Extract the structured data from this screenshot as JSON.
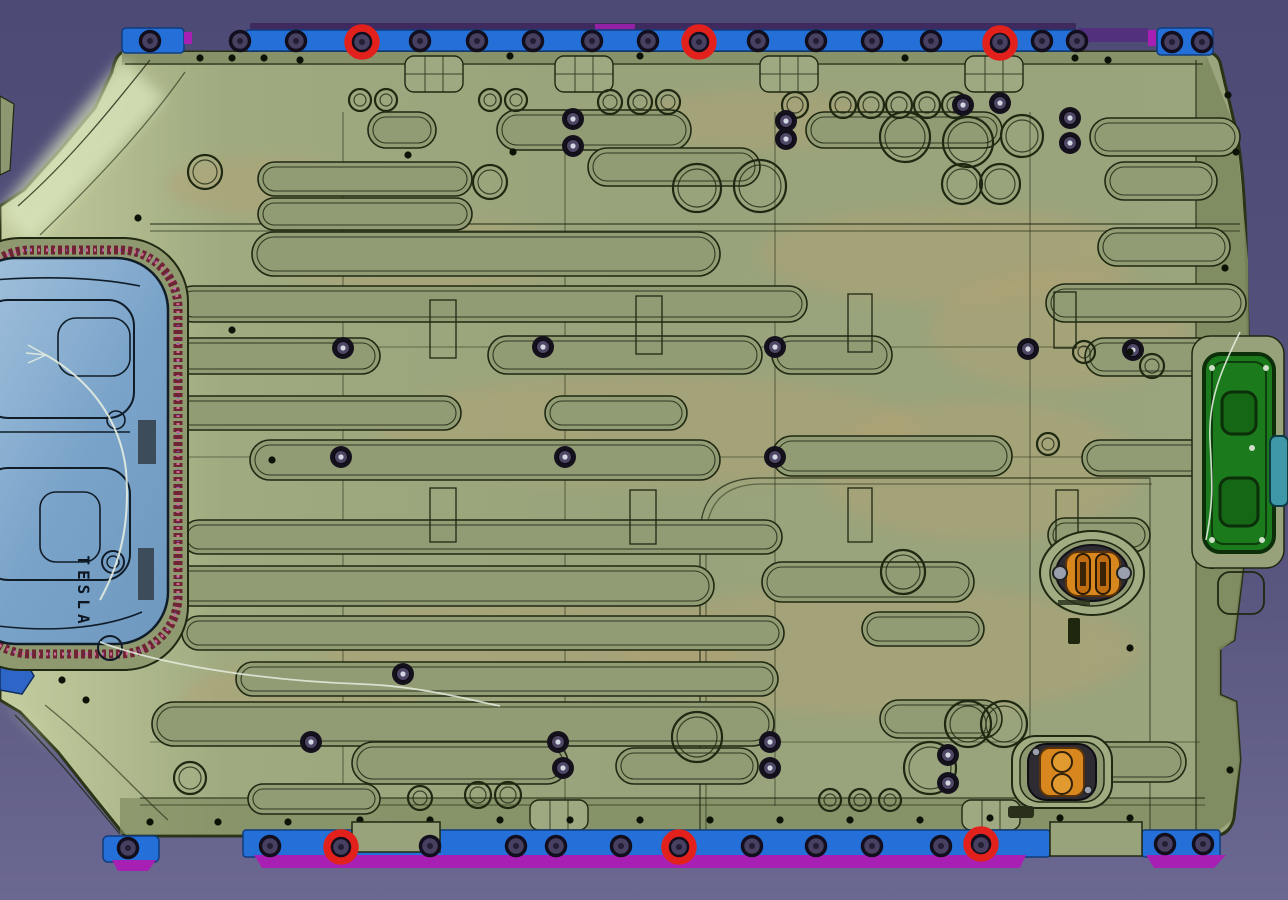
{
  "scene": {
    "type": "cad-viewport",
    "part_label": "TESLA",
    "palette": {
      "bg_top": "#4d4a76",
      "bg_mid": "#56537d",
      "bg_bottom": "#6b6892",
      "body": "#99a37b",
      "body_light": "#cdd7ac",
      "body_dark": "#7d895e",
      "body_band": "#8a9569",
      "line": "#1f2811",
      "channel": "#929c74",
      "rail_blue": "#2470d8",
      "rail_blue_dark": "#113c7e",
      "magenta": "#a81fb4",
      "purple_strip": "#3f2a60",
      "bolt_fill": "#474060",
      "bolt_ring": "#120e1d",
      "tan": "#b3a274",
      "panel_blue": "#7ea7cb",
      "panel_blue_light": "#a8c6e0",
      "panel_line": "#101d29",
      "gasket_dark": "#6f2436",
      "gasket_pink": "#cf6e94",
      "cover_green": "#1b7a1c",
      "cover_green_dark": "#0c2f0a",
      "orange": "#d8871f",
      "orange_dark": "#5a3408",
      "housing": "#2e2b33",
      "teal": "#3f98a8",
      "highlight_red": "#e2211c",
      "wire": "#e4ecdf",
      "screw_dark": "#14111c",
      "screw_mid": "#4e4766",
      "screw_glint": "#d3d7e2",
      "dot": "#0d1207"
    },
    "highlight_circles": [
      [
        362,
        42
      ],
      [
        699,
        42
      ],
      [
        1000,
        43
      ],
      [
        341,
        847
      ],
      [
        679,
        847
      ],
      [
        981,
        844
      ]
    ],
    "top_rail_bolts": [
      [
        150,
        41
      ],
      [
        240,
        41
      ],
      [
        296,
        41
      ],
      [
        362,
        42
      ],
      [
        420,
        41
      ],
      [
        477,
        41
      ],
      [
        533,
        41
      ],
      [
        592,
        41
      ],
      [
        648,
        41
      ],
      [
        699,
        42
      ],
      [
        758,
        41
      ],
      [
        816,
        41
      ],
      [
        872,
        41
      ],
      [
        931,
        41
      ],
      [
        1000,
        42
      ],
      [
        1042,
        41
      ],
      [
        1077,
        41
      ],
      [
        1172,
        42
      ],
      [
        1202,
        42
      ]
    ],
    "bottom_rail_bolts": [
      [
        128,
        848
      ],
      [
        270,
        846
      ],
      [
        341,
        847
      ],
      [
        430,
        846
      ],
      [
        516,
        846
      ],
      [
        556,
        846
      ],
      [
        621,
        846
      ],
      [
        679,
        847
      ],
      [
        752,
        846
      ],
      [
        816,
        846
      ],
      [
        872,
        846
      ],
      [
        941,
        846
      ],
      [
        981,
        845
      ],
      [
        1165,
        844
      ],
      [
        1203,
        844
      ]
    ],
    "coolant_channels": [
      [
        368,
        112,
        68,
        36
      ],
      [
        497,
        110,
        194,
        40
      ],
      [
        806,
        112,
        196,
        36
      ],
      [
        1090,
        118,
        150,
        38
      ],
      [
        258,
        162,
        214,
        34
      ],
      [
        588,
        148,
        172,
        38
      ],
      [
        1105,
        162,
        112,
        38
      ],
      [
        258,
        198,
        214,
        32
      ],
      [
        1098,
        228,
        132,
        38
      ],
      [
        252,
        232,
        468,
        44
      ],
      [
        175,
        286,
        632,
        36
      ],
      [
        1046,
        284,
        200,
        38
      ],
      [
        148,
        338,
        232,
        36
      ],
      [
        488,
        336,
        274,
        38
      ],
      [
        772,
        336,
        120,
        38
      ],
      [
        1085,
        338,
        158,
        38
      ],
      [
        165,
        396,
        296,
        34
      ],
      [
        545,
        396,
        142,
        34
      ],
      [
        250,
        440,
        470,
        40
      ],
      [
        772,
        436,
        240,
        40
      ],
      [
        1082,
        440,
        158,
        36
      ],
      [
        182,
        520,
        600,
        34
      ],
      [
        1048,
        518,
        102,
        34
      ],
      [
        152,
        566,
        562,
        40
      ],
      [
        762,
        562,
        212,
        40
      ],
      [
        182,
        616,
        602,
        34
      ],
      [
        862,
        612,
        122,
        34
      ],
      [
        236,
        662,
        542,
        34
      ],
      [
        152,
        702,
        622,
        44
      ],
      [
        880,
        700,
        122,
        38
      ],
      [
        352,
        742,
        216,
        42
      ],
      [
        616,
        748,
        142,
        36
      ],
      [
        1016,
        742,
        170,
        40
      ],
      [
        248,
        784,
        132,
        30
      ]
    ],
    "bosses": [
      [
        360,
        100,
        11
      ],
      [
        386,
        100,
        11
      ],
      [
        490,
        100,
        11
      ],
      [
        516,
        100,
        11
      ],
      [
        610,
        102,
        12
      ],
      [
        640,
        102,
        12
      ],
      [
        668,
        102,
        12
      ],
      [
        795,
        105,
        13
      ],
      [
        843,
        105,
        13
      ],
      [
        871,
        105,
        13
      ],
      [
        899,
        105,
        13
      ],
      [
        927,
        105,
        13
      ],
      [
        955,
        105,
        13
      ],
      [
        905,
        137,
        25
      ],
      [
        968,
        142,
        25
      ],
      [
        1022,
        136,
        21
      ],
      [
        962,
        184,
        20
      ],
      [
        1000,
        184,
        20
      ],
      [
        760,
        186,
        26
      ],
      [
        697,
        188,
        24
      ],
      [
        490,
        182,
        17
      ],
      [
        205,
        172,
        17
      ],
      [
        903,
        572,
        22
      ],
      [
        1048,
        444,
        11
      ],
      [
        1152,
        366,
        12
      ],
      [
        1084,
        352,
        11
      ],
      [
        190,
        778,
        16
      ],
      [
        697,
        737,
        25
      ],
      [
        968,
        724,
        23
      ],
      [
        1004,
        724,
        23
      ],
      [
        930,
        768,
        26
      ],
      [
        830,
        800,
        11
      ],
      [
        860,
        800,
        11
      ],
      [
        890,
        800,
        11
      ],
      [
        478,
        795,
        13
      ],
      [
        508,
        795,
        13
      ],
      [
        420,
        798,
        12
      ]
    ],
    "screws": [
      [
        573,
        119
      ],
      [
        573,
        146
      ],
      [
        786,
        121
      ],
      [
        786,
        139
      ],
      [
        1070,
        118
      ],
      [
        1070,
        143
      ],
      [
        343,
        348
      ],
      [
        543,
        347
      ],
      [
        775,
        347
      ],
      [
        1028,
        349
      ],
      [
        1133,
        350
      ],
      [
        341,
        457
      ],
      [
        565,
        457
      ],
      [
        775,
        457
      ],
      [
        311,
        742
      ],
      [
        403,
        674
      ],
      [
        558,
        742
      ],
      [
        563,
        768
      ],
      [
        770,
        742
      ],
      [
        770,
        768
      ],
      [
        948,
        755
      ],
      [
        948,
        783
      ],
      [
        963,
        105
      ],
      [
        1000,
        103
      ],
      [
        1215,
        347
      ],
      [
        1212,
        558
      ]
    ],
    "edge_dots": [
      [
        200,
        58
      ],
      [
        232,
        58
      ],
      [
        264,
        58
      ],
      [
        300,
        60
      ],
      [
        510,
        56
      ],
      [
        640,
        56
      ],
      [
        905,
        58
      ],
      [
        1075,
        58
      ],
      [
        1108,
        60
      ],
      [
        408,
        155
      ],
      [
        513,
        152
      ],
      [
        272,
        460
      ],
      [
        232,
        330
      ],
      [
        138,
        218
      ],
      [
        130,
        610
      ],
      [
        150,
        822
      ],
      [
        218,
        822
      ],
      [
        288,
        822
      ],
      [
        360,
        820
      ],
      [
        430,
        820
      ],
      [
        500,
        820
      ],
      [
        570,
        820
      ],
      [
        640,
        820
      ],
      [
        710,
        820
      ],
      [
        780,
        820
      ],
      [
        850,
        820
      ],
      [
        920,
        820
      ],
      [
        990,
        818
      ],
      [
        1060,
        818
      ],
      [
        1130,
        818
      ],
      [
        1228,
        95
      ],
      [
        1236,
        152
      ],
      [
        1130,
        352
      ],
      [
        1130,
        648
      ],
      [
        1225,
        268
      ],
      [
        1230,
        770
      ],
      [
        62,
        680
      ],
      [
        86,
        700
      ]
    ],
    "stiffener_slots": [
      [
        430,
        300,
        26,
        58
      ],
      [
        636,
        296,
        26,
        58
      ],
      [
        848,
        294,
        24,
        58
      ],
      [
        1054,
        292,
        22,
        56
      ],
      [
        430,
        488,
        26,
        54
      ],
      [
        630,
        490,
        26,
        54
      ],
      [
        848,
        488,
        24,
        54
      ],
      [
        1056,
        490,
        22,
        52
      ],
      [
        62,
        342,
        26,
        60
      ]
    ],
    "tan_patches": [
      [
        650,
        430,
        270,
        55
      ],
      [
        420,
        255,
        150,
        38
      ],
      [
        950,
        255,
        190,
        48
      ],
      [
        530,
        645,
        210,
        48
      ],
      [
        880,
        650,
        260,
        65
      ],
      [
        300,
        700,
        120,
        38
      ],
      [
        1060,
        330,
        130,
        60
      ],
      [
        260,
        185,
        95,
        30
      ],
      [
        760,
        120,
        120,
        30
      ],
      [
        980,
        470,
        160,
        70
      ]
    ],
    "bridges": [
      [
        405,
        56
      ],
      [
        555,
        56
      ],
      [
        760,
        56
      ],
      [
        965,
        56
      ]
    ],
    "bottom_bridges": [
      [
        530,
        800
      ],
      [
        962,
        800
      ]
    ]
  }
}
